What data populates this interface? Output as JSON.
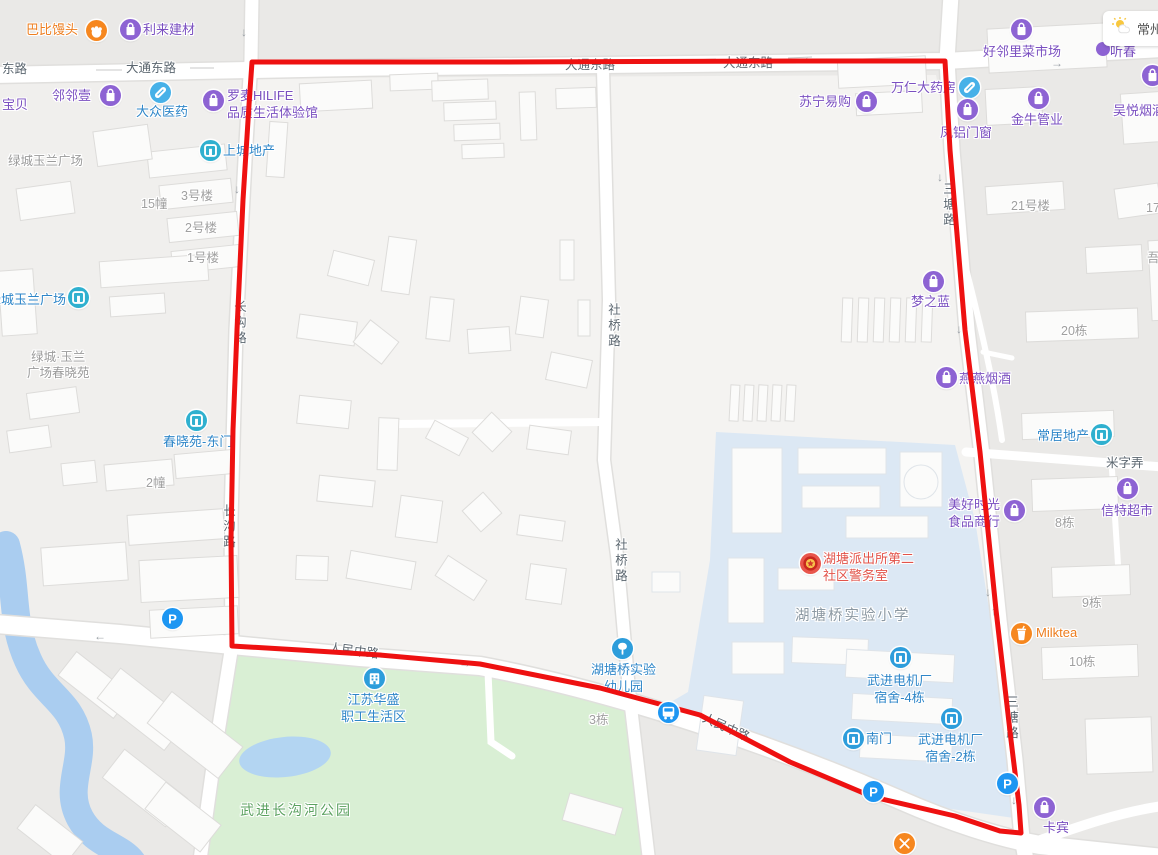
{
  "map": {
    "weather": {
      "city": "常州"
    },
    "palette": {
      "purple_text": "#7a4fc0",
      "purple_icon": "#8d63d3",
      "blue_text": "#2e86c8",
      "blue_icon": "#2d9ddb",
      "teal_icon": "#2fb0cf",
      "pill_icon": "#47b1e8",
      "parking_icon": "#1d96f2",
      "orange_text": "#ed7d1e",
      "orange_icon": "#f6871f",
      "red_text": "#e2534a",
      "police_icon": "#e8564c",
      "route": "#ee1111"
    },
    "route": {
      "points": [
        [
          252,
          62
        ],
        [
          500,
          62
        ],
        [
          800,
          61
        ],
        [
          945,
          61
        ],
        [
          950,
          150
        ],
        [
          965,
          330
        ],
        [
          980,
          452
        ],
        [
          996,
          610
        ],
        [
          1011,
          740
        ],
        [
          1019,
          805
        ],
        [
          1021,
          833
        ],
        [
          1000,
          831
        ],
        [
          955,
          816
        ],
        [
          873,
          797
        ],
        [
          790,
          762
        ],
        [
          700,
          715
        ],
        [
          600,
          688
        ],
        [
          480,
          664
        ],
        [
          380,
          655
        ],
        [
          300,
          650
        ],
        [
          232,
          646
        ],
        [
          231,
          540
        ],
        [
          233,
          430
        ],
        [
          237,
          330
        ],
        [
          243,
          200
        ],
        [
          249,
          105
        ],
        [
          252,
          62
        ]
      ]
    },
    "road_labels": [
      {
        "t": "东路",
        "x": 2,
        "y": 62
      },
      {
        "t": "大通东路",
        "x": 126,
        "y": 61
      },
      {
        "t": "大通东路",
        "x": 565,
        "y": 58
      },
      {
        "t": "大通东路",
        "x": 723,
        "y": 56
      },
      {
        "t": "长沟路",
        "x": 231,
        "y": 300,
        "v": 1
      },
      {
        "t": "长沟路",
        "x": 220,
        "y": 504,
        "v": 1
      },
      {
        "t": "社桥路",
        "x": 605,
        "y": 303,
        "v": 1
      },
      {
        "t": "社桥路",
        "x": 612,
        "y": 538,
        "v": 1
      },
      {
        "t": "三塘路",
        "x": 940,
        "y": 182,
        "v": 1
      },
      {
        "t": "三塘路",
        "x": 1003,
        "y": 695,
        "v": 1
      },
      {
        "t": "米字弄",
        "x": 1106,
        "y": 456
      },
      {
        "t": "人民中路",
        "x": 330,
        "y": 641,
        "r": 7
      },
      {
        "t": "人民中路",
        "x": 706,
        "y": 711,
        "r": 24
      }
    ],
    "area_labels": [
      {
        "t": "绿城玉兰广场",
        "x": 8,
        "y": 153,
        "cls": "blk"
      },
      {
        "t": "3号楼",
        "x": 181,
        "y": 188
      },
      {
        "t": "15幢",
        "x": 141,
        "y": 196
      },
      {
        "t": "2号楼",
        "x": 185,
        "y": 220
      },
      {
        "t": "1号楼",
        "x": 187,
        "y": 250
      },
      {
        "t": "绿城·玉兰\n广场春晓苑",
        "x": 27,
        "y": 349,
        "center": 1,
        "cls": "blk"
      },
      {
        "t": "2幢",
        "x": 146,
        "y": 475
      },
      {
        "t": "21号楼",
        "x": 1011,
        "y": 198
      },
      {
        "t": "17栋",
        "x": 1146,
        "y": 200
      },
      {
        "t": "吾",
        "x": 1147,
        "y": 250
      },
      {
        "t": "20栋",
        "x": 1061,
        "y": 323
      },
      {
        "t": "8栋",
        "x": 1055,
        "y": 515
      },
      {
        "t": "9栋",
        "x": 1082,
        "y": 595
      },
      {
        "t": "10栋",
        "x": 1069,
        "y": 654
      },
      {
        "t": "3栋",
        "x": 589,
        "y": 712
      },
      {
        "t": "湖塘桥实验小学",
        "x": 795,
        "y": 608,
        "cls": "school"
      },
      {
        "t": "武进长沟河公园",
        "x": 240,
        "y": 802,
        "cls": "park"
      }
    ],
    "arrows": [
      {
        "d": "↓",
        "x": 241,
        "y": 25
      },
      {
        "d": "←",
        "x": 803,
        "y": 50
      },
      {
        "d": "→",
        "x": 1051,
        "y": 56
      },
      {
        "d": "↓",
        "x": 234,
        "y": 182
      },
      {
        "d": "↓",
        "x": 937,
        "y": 170
      },
      {
        "d": "↓",
        "x": 956,
        "y": 322
      },
      {
        "d": "←",
        "x": 94,
        "y": 629
      },
      {
        "d": "→",
        "x": 459,
        "y": 656
      },
      {
        "d": "↓",
        "x": 985,
        "y": 585
      },
      {
        "d": "↑",
        "x": 991,
        "y": 604
      },
      {
        "d": "↓",
        "x": 1011,
        "y": 793
      }
    ],
    "pois": [
      {
        "name": "巴比馒头",
        "lines": [
          "巴比馒头"
        ],
        "tx": 26,
        "ty": 21,
        "color": "orange_text",
        "icon": "hand",
        "icon_color": "orange_icon",
        "ix": 96,
        "iy": 30
      },
      {
        "name": "利来建材",
        "lines": [
          "利来建材"
        ],
        "tx": 143,
        "ty": 21,
        "color": "purple_text",
        "icon": "bag",
        "icon_color": "purple_icon",
        "ix": 130,
        "iy": 29
      },
      {
        "name": "邻邻壹",
        "lines": [
          "邻邻壹"
        ],
        "tx": 52,
        "ty": 87,
        "color": "purple_text",
        "icon": "bag",
        "icon_color": "purple_icon",
        "ix": 110,
        "iy": 95
      },
      {
        "name": "宝贝",
        "lines": [
          "宝贝"
        ],
        "tx": 2,
        "ty": 96,
        "color": "purple_text"
      },
      {
        "name": "大众医药",
        "lines": [
          "大众医药"
        ],
        "tx": 136,
        "ty": 103,
        "color": "blue_text",
        "icon": "pill",
        "icon_color": "pill_icon",
        "ix": 160,
        "iy": 92
      },
      {
        "name": "罗麦HILIFE品质生活体验馆",
        "lines": [
          "罗麦HILIFE",
          "品质生活体验馆"
        ],
        "tx": 227,
        "ty": 87,
        "color": "purple_text",
        "icon": "bag",
        "icon_color": "purple_icon",
        "ix": 213,
        "iy": 100
      },
      {
        "name": "上城地产",
        "lines": [
          "上城地产"
        ],
        "tx": 223,
        "ty": 142,
        "color": "blue_text",
        "icon": "door",
        "icon_color": "teal_icon",
        "ix": 210,
        "iy": 150
      },
      {
        "name": "苏宁易购",
        "lines": [
          "苏宁易购"
        ],
        "tx": 799,
        "ty": 93,
        "color": "purple_text",
        "icon": "bag",
        "icon_color": "purple_icon",
        "ix": 866,
        "iy": 101
      },
      {
        "name": "万仁大药房",
        "lines": [
          "万仁大药房"
        ],
        "tx": 891,
        "ty": 79,
        "color": "purple_text",
        "icon": "pill",
        "icon_color": "pill_icon",
        "ix": 969,
        "iy": 87
      },
      {
        "name": "凤铝门窗",
        "lines": [
          "凤铝门窗"
        ],
        "tx": 940,
        "ty": 124,
        "color": "purple_text",
        "icon": "bag",
        "icon_color": "purple_icon",
        "ix": 967,
        "iy": 109
      },
      {
        "name": "好邻里菜市场",
        "lines": [
          "好邻里菜市场"
        ],
        "tx": 983,
        "ty": 43,
        "color": "purple_text",
        "icon": "bag",
        "icon_color": "purple_icon",
        "ix": 1021,
        "iy": 29
      },
      {
        "name": "金牛管业",
        "lines": [
          "金牛管业"
        ],
        "tx": 1011,
        "ty": 111,
        "color": "purple_text",
        "icon": "bag",
        "icon_color": "purple_icon",
        "ix": 1038,
        "iy": 98
      },
      {
        "name": "吴悦烟酒",
        "lines": [
          "吴悦烟酒"
        ],
        "tx": 1113,
        "ty": 102,
        "color": "purple_text",
        "icon": "bag",
        "icon_color": "purple_icon",
        "ix": 1152,
        "iy": 75
      },
      {
        "name": "听春",
        "lines": [
          "听春"
        ],
        "tx": 1110,
        "ty": 43,
        "color": "purple_text"
      },
      {
        "name": "梦之蓝",
        "lines": [
          "梦之蓝"
        ],
        "tx": 911,
        "ty": 293,
        "color": "purple_text",
        "icon": "bag",
        "icon_color": "purple_icon",
        "ix": 933,
        "iy": 281
      },
      {
        "name": "燕燕烟酒",
        "lines": [
          "燕燕烟酒"
        ],
        "tx": 959,
        "ty": 370,
        "color": "purple_text",
        "icon": "bag",
        "icon_color": "purple_icon",
        "ix": 946,
        "iy": 377
      },
      {
        "name": "常居地产",
        "lines": [
          "常居地产"
        ],
        "tx": 1037,
        "ty": 427,
        "color": "blue_text",
        "icon": "door",
        "icon_color": "teal_icon",
        "ix": 1101,
        "iy": 434
      },
      {
        "name": "信特超市",
        "lines": [
          "信特超市"
        ],
        "tx": 1101,
        "ty": 502,
        "color": "purple_text",
        "icon": "bag",
        "icon_color": "purple_icon",
        "ix": 1127,
        "iy": 488
      },
      {
        "name": "美好时光食品商行",
        "lines": [
          "美好时光",
          "食品商行"
        ],
        "tx": 948,
        "ty": 496,
        "color": "purple_text",
        "icon": "bag",
        "icon_color": "purple_icon",
        "ix": 1014,
        "iy": 510
      },
      {
        "name": "Milktea",
        "lines": [
          "Milktea"
        ],
        "tx": 1036,
        "ty": 624,
        "color": "orange_text",
        "icon": "cup",
        "icon_color": "orange_icon",
        "ix": 1021,
        "iy": 633
      },
      {
        "name": "卡宾",
        "lines": [
          "卡宾"
        ],
        "tx": 1043,
        "ty": 819,
        "color": "purple_text",
        "icon": "bag",
        "icon_color": "purple_icon",
        "ix": 1044,
        "iy": 807
      },
      {
        "name": "湖塘派出所第二社区警务室",
        "lines": [
          "湖塘派出所第二",
          "社区警务室"
        ],
        "tx": 823,
        "ty": 550,
        "color": "red_text",
        "icon": "police",
        "icon_color": "police_icon",
        "ix": 810,
        "iy": 563
      },
      {
        "name": "武进电机厂宿舍-4栋",
        "lines": [
          "武进电机厂",
          "宿舍-4栋"
        ],
        "tx": 867,
        "ty": 672,
        "color": "blue_text",
        "icon": "door",
        "icon_color": "blue_icon",
        "ix": 900,
        "iy": 657,
        "align": "center"
      },
      {
        "name": "南门",
        "lines": [
          "南门"
        ],
        "tx": 866,
        "ty": 730,
        "color": "blue_text",
        "icon": "door",
        "icon_color": "blue_icon",
        "ix": 853,
        "iy": 738
      },
      {
        "name": "武进电机厂宿舍-2栋",
        "lines": [
          "武进电机厂",
          "宿舍-2栋"
        ],
        "tx": 918,
        "ty": 731,
        "color": "blue_text",
        "icon": "door",
        "icon_color": "blue_icon",
        "ix": 951,
        "iy": 718,
        "align": "center"
      },
      {
        "name": "湖塘桥实验幼儿园",
        "lines": [
          "湖塘桥实验",
          "幼儿园"
        ],
        "tx": 591,
        "ty": 661,
        "color": "blue_text",
        "icon": "tree",
        "icon_color": "blue_icon",
        "ix": 622,
        "iy": 648,
        "align": "center"
      },
      {
        "name": "江苏华盛职工生活区",
        "lines": [
          "江苏华盛",
          "职工生活区"
        ],
        "tx": 341,
        "ty": 691,
        "color": "blue_text",
        "icon": "building",
        "icon_color": "blue_icon",
        "ix": 374,
        "iy": 678,
        "align": "center"
      },
      {
        "name": "春晓苑-东门",
        "lines": [
          "春晓苑-东门"
        ],
        "tx": 163,
        "ty": 433,
        "color": "blue_text",
        "icon": "door",
        "icon_color": "teal_icon",
        "ix": 196,
        "iy": 420
      },
      {
        "name": "绿城玉兰广场",
        "lines": [
          "绿城玉兰广场"
        ],
        "tx": -12,
        "ty": 291,
        "color": "blue_text",
        "icon": "door",
        "icon_color": "teal_icon",
        "ix": 78,
        "iy": 297
      },
      {
        "name": "停车场",
        "lines": [],
        "icon": "parking",
        "icon_color": "parking_icon",
        "ix": 172,
        "iy": 618
      },
      {
        "name": "停车场",
        "lines": [],
        "icon": "parking",
        "icon_color": "parking_icon",
        "ix": 873,
        "iy": 791
      },
      {
        "name": "停车场",
        "lines": [],
        "icon": "parking",
        "icon_color": "parking_icon",
        "ix": 1007,
        "iy": 783
      },
      {
        "name": "公交站",
        "lines": [],
        "icon": "bus",
        "icon_color": "parking_icon",
        "ix": 668,
        "iy": 712
      },
      {
        "name": "餐饮",
        "lines": [],
        "icon": "fork",
        "icon_color": "orange_icon",
        "ix": 904,
        "iy": 843
      }
    ]
  }
}
